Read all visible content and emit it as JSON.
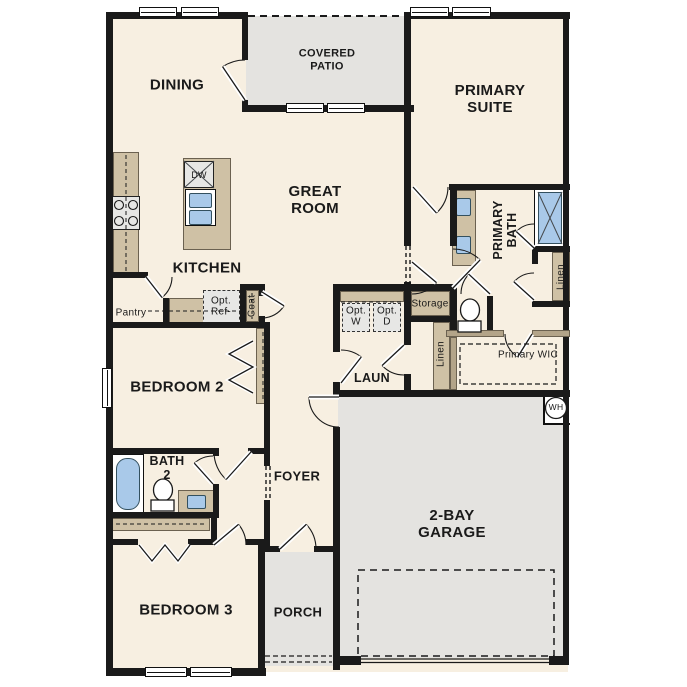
{
  "floor_plan": {
    "rooms": {
      "dining": "DINING",
      "covered_patio": "COVERED PATIO",
      "great_room": "GREAT ROOM",
      "kitchen": "KITCHEN",
      "primary_suite": "PRIMARY SUITE",
      "primary_bath": "PRIMARY BATH",
      "primary_wic": "Primary WIC",
      "laundry": "LAUN",
      "bedroom_2": "BEDROOM 2",
      "bath_2": "BATH 2",
      "bedroom_3": "BEDROOM 3",
      "foyer": "FOYER",
      "porch": "PORCH",
      "garage": "2-BAY GARAGE"
    },
    "closets": {
      "pantry": "Pantry",
      "coat": "Coat",
      "storage": "Storage",
      "linen_hall": "Linen",
      "linen_primary": "Linen"
    },
    "appliances": {
      "dishwasher": "DW",
      "optional_refrigerator": "Opt. Ref-",
      "optional_washer": "Opt. W",
      "optional_dryer": "Opt. D",
      "water_heater": "WH"
    },
    "colors": {
      "wall": "#1a1a1a",
      "floor": "#f7efe1",
      "outdoor": "#e4e3e0",
      "cabinetry": "#cfc1a5",
      "plumbing_blue": "#a9c9e9",
      "appliance_gray": "#e7e7e5"
    }
  }
}
